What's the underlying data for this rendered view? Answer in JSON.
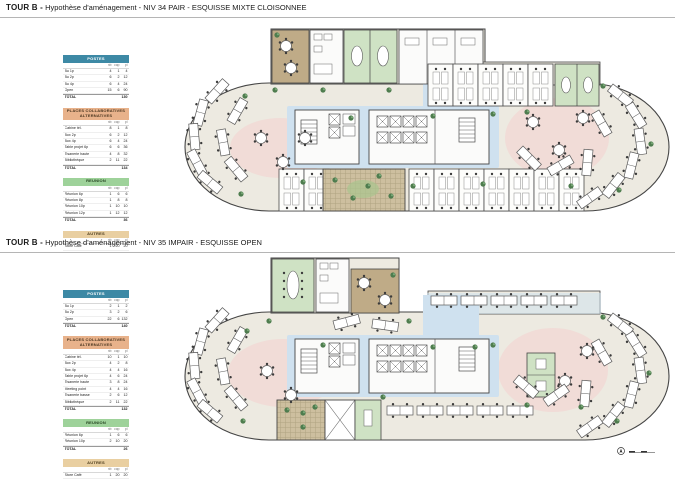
{
  "page": {
    "background": "#ffffff"
  },
  "colors": {
    "plate_beige": "#edeae1",
    "core_blue": "#cfe1ef",
    "collab_pink": "#f1dad6",
    "meeting_green": "#cfe2c4",
    "cafe_tan": "#bfab87",
    "terrace_tan": "#cdbf9f",
    "wall": "#454545",
    "postes_header_bg": "#3d89a5",
    "postes_header_fg": "#ffffff",
    "places_header_bg": "#e8b28b",
    "places_header_fg": "#4a3620",
    "reunion_header_bg": "#9ed29a",
    "reunion_header_fg": "#23421f",
    "autres_header_bg": "#e9cfa1",
    "autres_header_fg": "#4a3a1a"
  },
  "sections": [
    {
      "id": "niv34",
      "title_prefix": "TOUR B -",
      "title_rest": " Hypothèse d'aménagement - NIV 34 PAIR - ESQUISSE MIXTE CLOISONNEE",
      "legend": {
        "groups": [
          {
            "name": "POSTES",
            "style": "postes",
            "columns": [
              "nb",
              "cap",
              "pl"
            ],
            "rows": [
              [
                "Bu 1p",
                "4",
                "1",
                "4"
              ],
              [
                "Bu 2p",
                "6",
                "2",
                "12"
              ],
              [
                "Bu 4p",
                "6",
                "4",
                "24"
              ],
              [
                "Open",
                "15",
                "6",
                "90"
              ]
            ],
            "total_label": "TOTAL",
            "total_value": "130"
          },
          {
            "name": "PLACES COLLABORATIVES ALTERNATIVES",
            "style": "places",
            "columns": [
              "nb",
              "cap",
              "pl"
            ],
            "rows": [
              [
                "Cabine tél.",
                "8",
                "1",
                "8"
              ],
              [
                "Box 2p",
                "6",
                "2",
                "12"
              ],
              [
                "Box 4p",
                "6",
                "4",
                "24"
              ],
              [
                "Table projet 6p",
                "6",
                "6",
                "36"
              ],
              [
                "Tisanerie haute",
                "4",
                "8",
                "32"
              ],
              [
                "Bibliothèque",
                "2",
                "11",
                "22"
              ]
            ],
            "total_label": "TOTAL",
            "total_value": "134"
          },
          {
            "name": "REUNION",
            "style": "reunion",
            "columns": [
              "nb",
              "cap",
              "pl"
            ],
            "rows": [
              [
                "Réunion 6p",
                "1",
                "6",
                "6"
              ],
              [
                "Réunion 8p",
                "1",
                "8",
                "8"
              ],
              [
                "Réunion 10p",
                "1",
                "10",
                "10"
              ],
              [
                "Réunion 12p",
                "1",
                "12",
                "12"
              ]
            ],
            "total_label": "TOTAL",
            "total_value": "36"
          },
          {
            "name": "AUTRES",
            "style": "autres",
            "columns": [
              "nb",
              "cap",
              "pl"
            ],
            "rows": [
              [
                "Store Café",
                "1",
                "20",
                "20"
              ]
            ],
            "total_label": null,
            "total_value": null
          }
        ]
      }
    },
    {
      "id": "niv35",
      "title_prefix": "TOUR B -",
      "title_rest": " Hypothèse d'aménagement - NIV 35 IMPAIR - ESQUISSE OPEN",
      "legend": {
        "groups": [
          {
            "name": "POSTES",
            "style": "postes",
            "columns": [
              "nb",
              "cap",
              "pl"
            ],
            "rows": [
              [
                "Bu 1p",
                "2",
                "1",
                "2"
              ],
              [
                "Bu 2p",
                "3",
                "2",
                "6"
              ],
              [
                "Open",
                "22",
                "6",
                "132"
              ]
            ],
            "total_label": "TOTAL",
            "total_value": "140"
          },
          {
            "name": "PLACES COLLABORATIVES ALTERNATIVES",
            "style": "places",
            "columns": [
              "nb",
              "cap",
              "pl"
            ],
            "rows": [
              [
                "Cabine tél.",
                "10",
                "1",
                "10"
              ],
              [
                "Box 2p",
                "4",
                "2",
                "8"
              ],
              [
                "Box 4p",
                "4",
                "4",
                "16"
              ],
              [
                "Table projet 6p",
                "4",
                "6",
                "24"
              ],
              [
                "Tisanerie haute",
                "3",
                "8",
                "24"
              ],
              [
                "Meeting point",
                "4",
                "4",
                "16"
              ],
              [
                "Tisanerie basse",
                "2",
                "6",
                "12"
              ],
              [
                "Bibliothèque",
                "2",
                "11",
                "22"
              ]
            ],
            "total_label": "TOTAL",
            "total_value": "132"
          },
          {
            "name": "REUNION",
            "style": "reunion",
            "columns": [
              "nb",
              "cap",
              "pl"
            ],
            "rows": [
              [
                "Réunion 6p",
                "1",
                "6",
                "6"
              ],
              [
                "Réunion 10p",
                "2",
                "10",
                "20"
              ]
            ],
            "total_label": "TOTAL",
            "total_value": "26"
          },
          {
            "name": "AUTRES",
            "style": "autres",
            "columns": [
              "nb",
              "cap",
              "pl"
            ],
            "rows": [
              [
                "Store Café",
                "1",
                "20",
                "20"
              ]
            ],
            "total_label": null,
            "total_value": null
          }
        ]
      }
    }
  ]
}
